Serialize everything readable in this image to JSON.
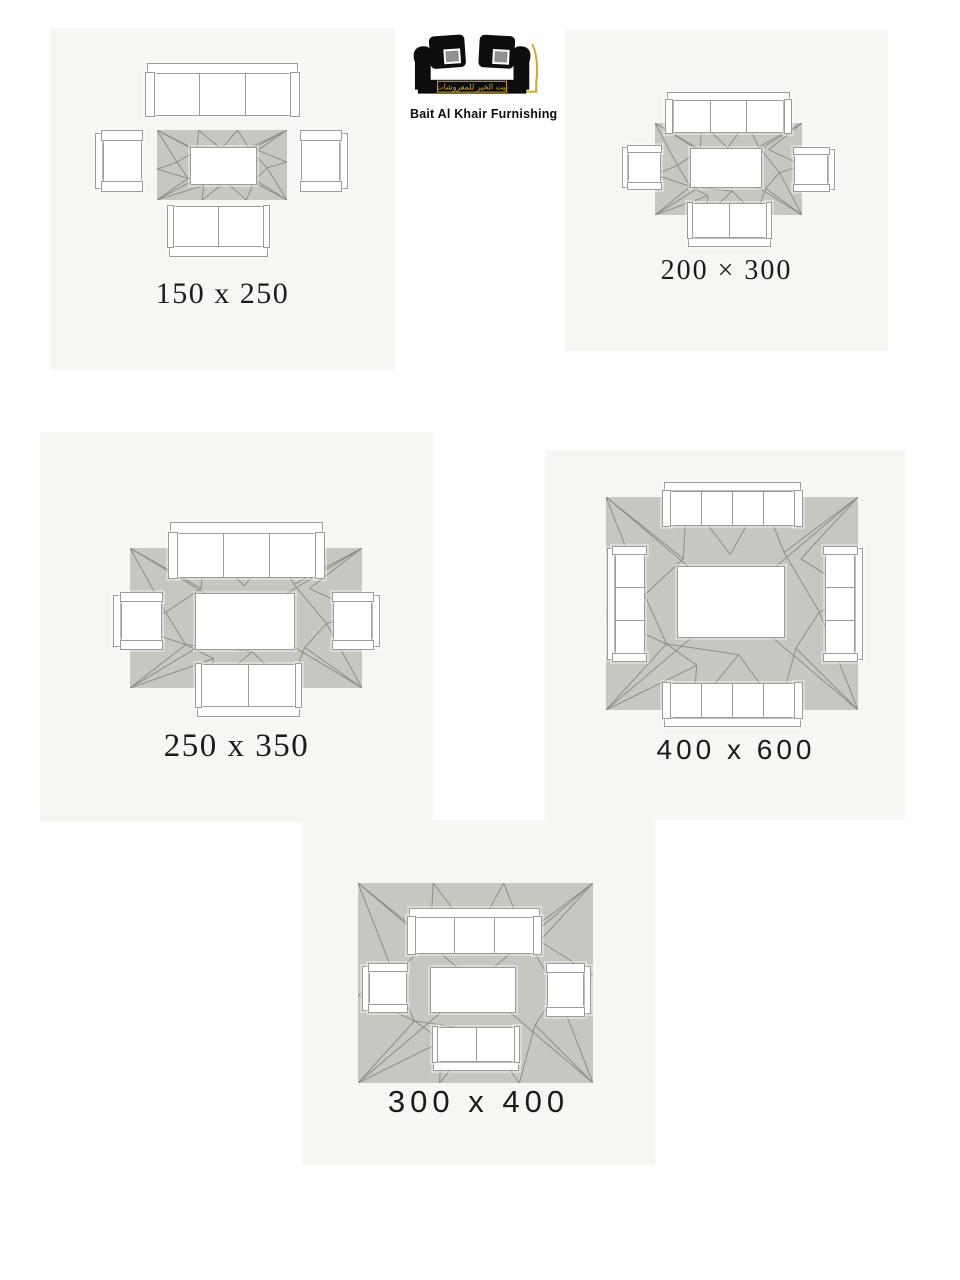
{
  "brand": {
    "arabic_text": "بيت الخير للمفروشات",
    "english_text": "Bait Al Khair Furnishing"
  },
  "colors": {
    "page_bg": "#ffffff",
    "card_bg": "#f6f6f3",
    "rug_fill": "#c7c7c2",
    "rug_line": "#8e8e88",
    "furniture_fill": "#ffffff",
    "furniture_outline": "#9b9b98",
    "label_text": "#1b1b1b",
    "logo_black": "#0d0d0d",
    "logo_gold": "#d2a52f",
    "pillow_inner_gray": "#909090"
  },
  "cards": [
    {
      "id": "150x250",
      "size_label": "150 x 250"
    },
    {
      "id": "200x300",
      "size_label": "200 × 300"
    },
    {
      "id": "250x350",
      "size_label": "250 x 350"
    },
    {
      "id": "400x600",
      "size_label": "400 x 600"
    },
    {
      "id": "300x400",
      "size_label": "300 x 400"
    }
  ]
}
